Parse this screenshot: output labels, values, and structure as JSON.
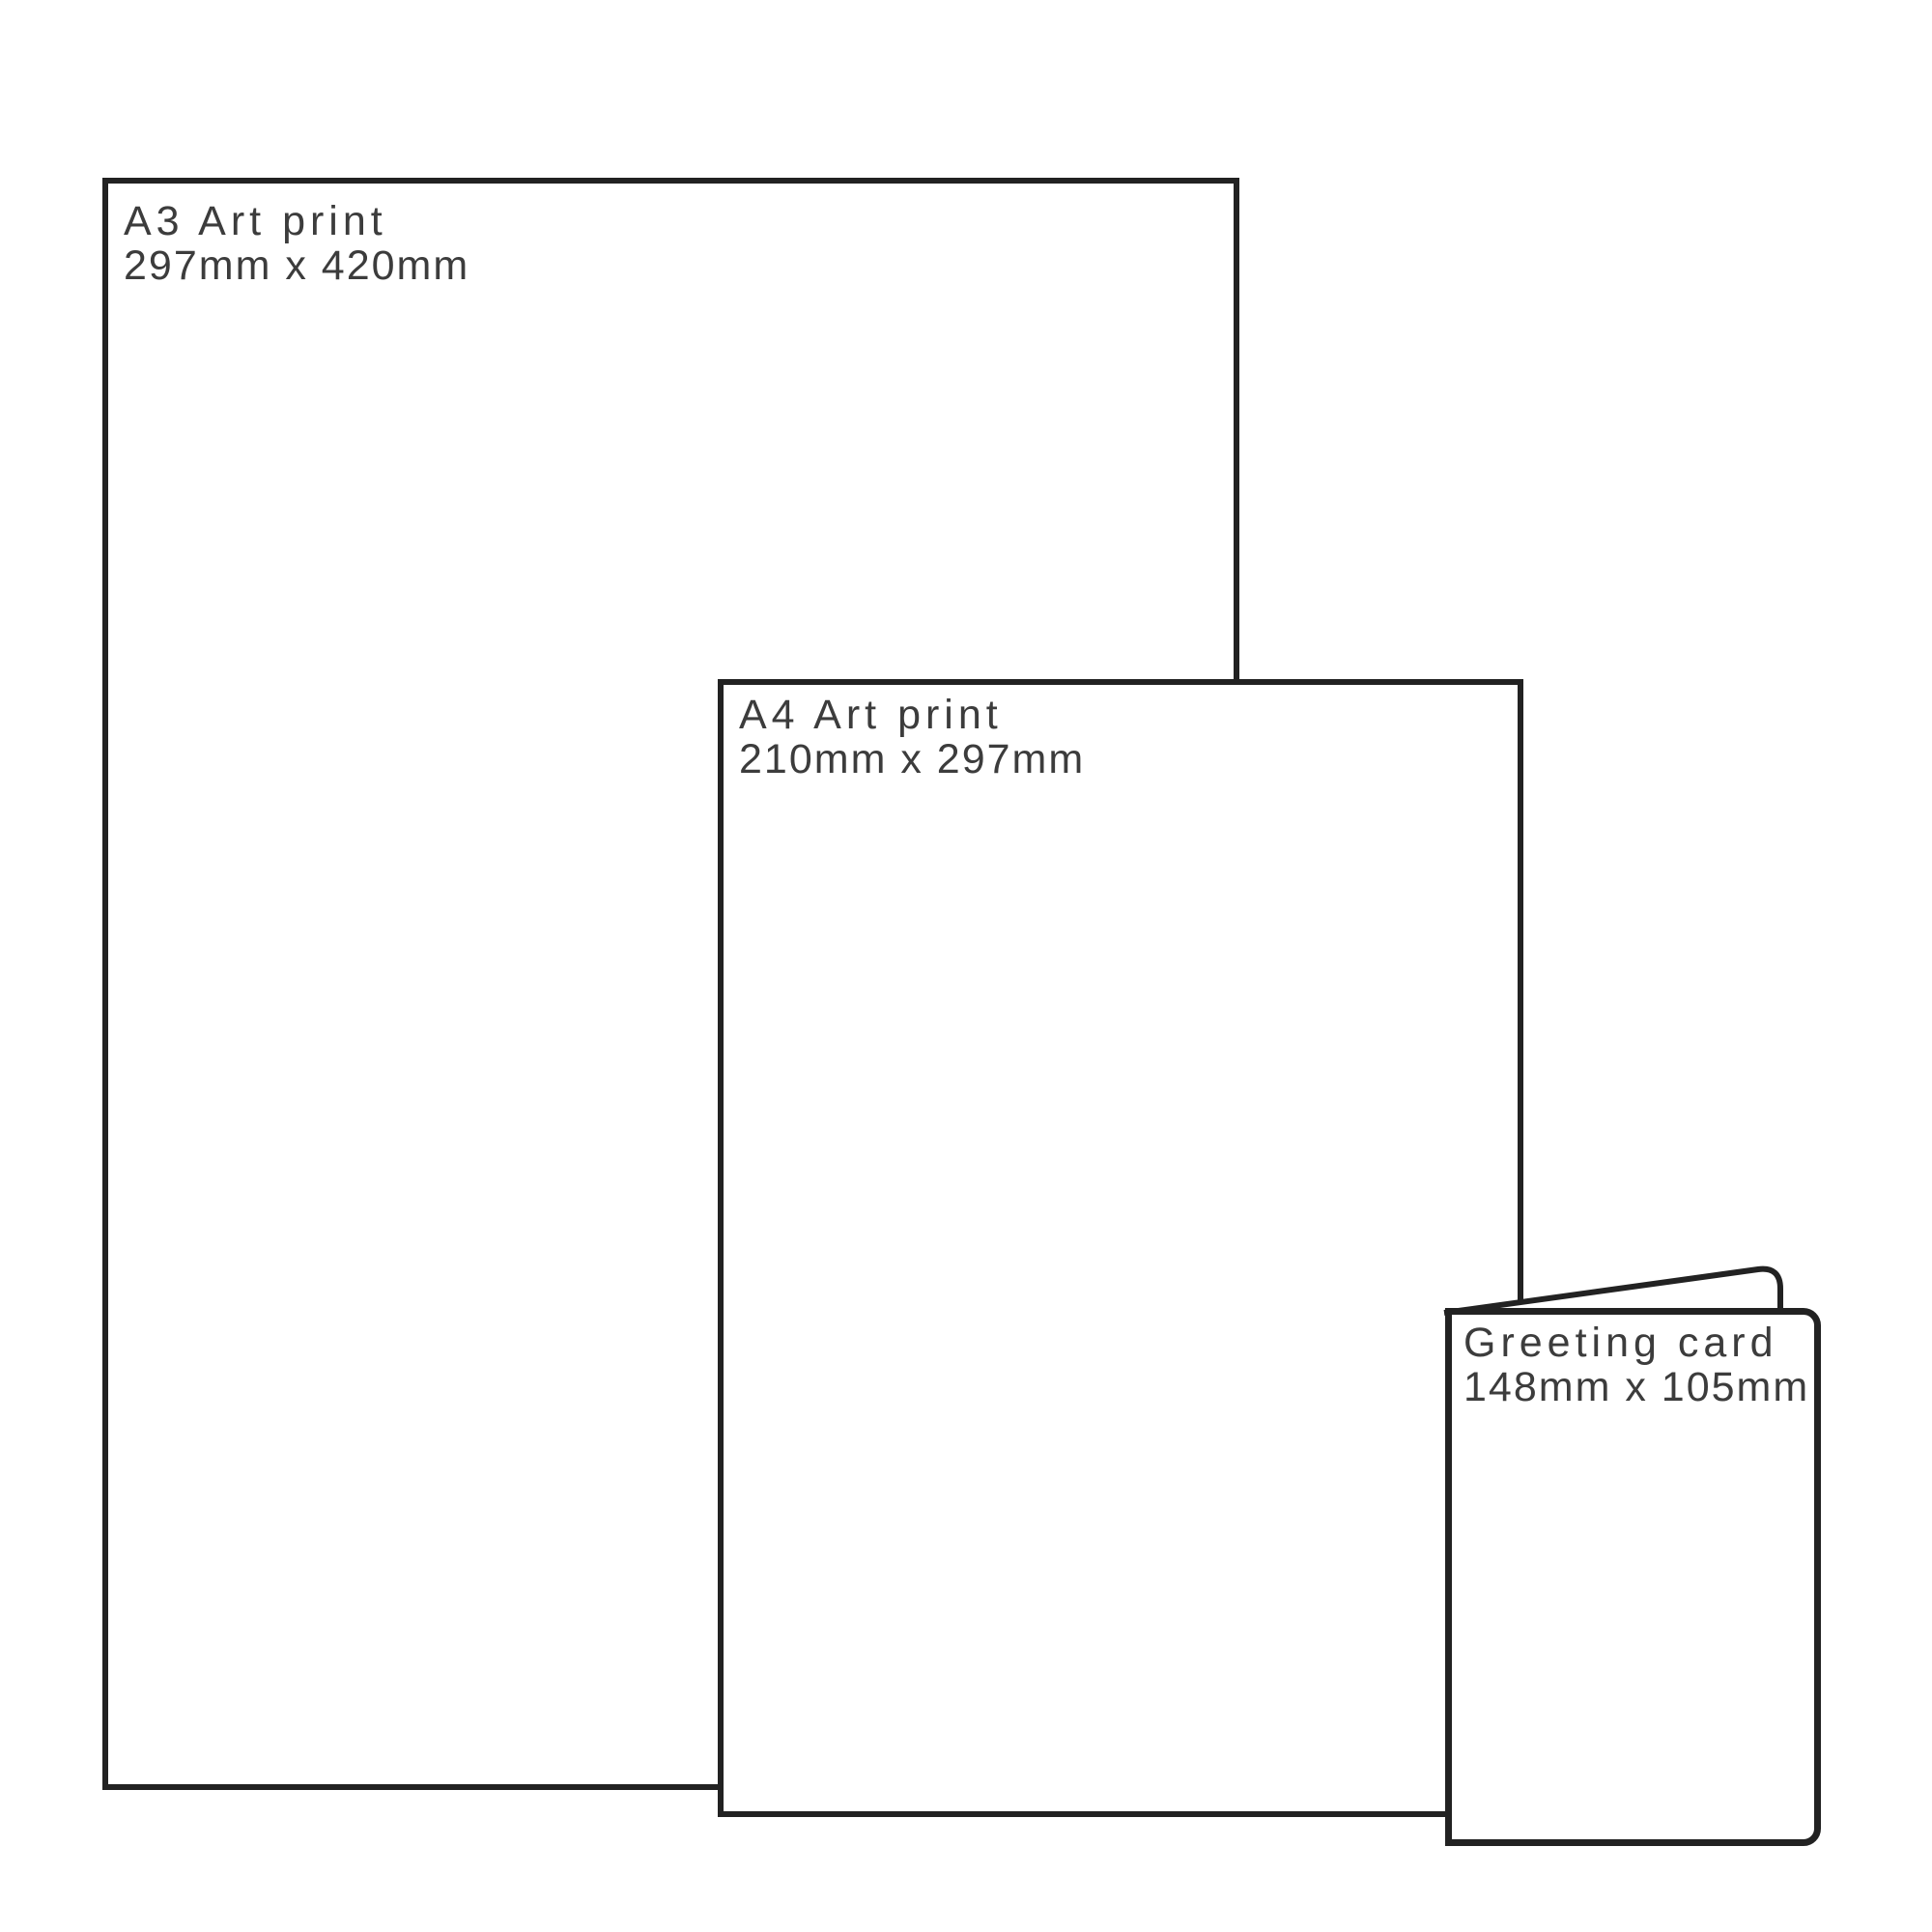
{
  "diagram": {
    "background_color": "#ffffff",
    "outline_color": "#222222",
    "label_color": "#3c3c3c",
    "sizes": [
      {
        "title": "A3 Art print",
        "dimensions": "297mm x 420mm"
      },
      {
        "title": "A4 Art print",
        "dimensions": "210mm x 297mm"
      },
      {
        "title": "Greeting card",
        "dimensions": "148mm x 105mm"
      }
    ]
  }
}
